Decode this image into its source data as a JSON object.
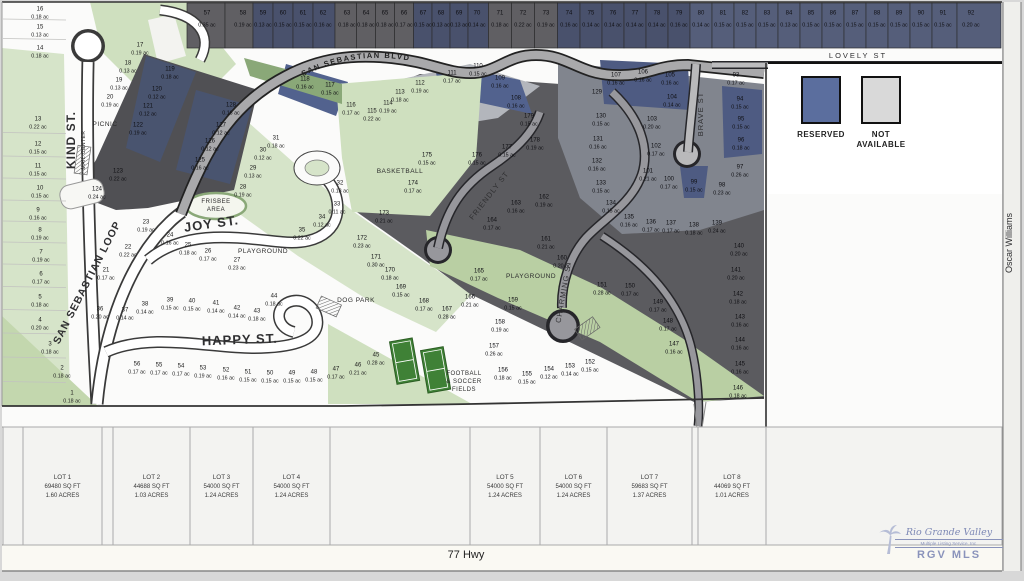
{
  "title": "Subdivision plat map",
  "legend": {
    "items": [
      {
        "label": "RESERVED",
        "color": "#5b6e9e"
      },
      {
        "label": "NOT AVAILABLE",
        "color": "#d9d9d9"
      }
    ]
  },
  "highway": {
    "label": "77 Hwy"
  },
  "logo": {
    "line1": "Rio Grande Valley",
    "line2": "Multiple Listing Service, Inc.",
    "line3": "RGV MLS"
  },
  "streets": [
    {
      "t": "KIND ST.",
      "x": 75,
      "y": 140,
      "r": -90,
      "s": 12,
      "ls": 1,
      "b": true
    },
    {
      "t": "SAN SEBASTIAN LOOP",
      "x": 90,
      "y": 284,
      "r": -63,
      "s": 10.5,
      "ls": 1,
      "b": true
    },
    {
      "t": "JOY ST.",
      "x": 212,
      "y": 228,
      "r": -8,
      "s": 13,
      "ls": 1,
      "b": true
    },
    {
      "t": "HAPPY ST.",
      "x": 240,
      "y": 344,
      "r": -2,
      "s": 13,
      "ls": 1,
      "b": true
    },
    {
      "t": "FRIENDLY ST",
      "x": 491,
      "y": 197,
      "r": -52,
      "s": 7.5,
      "ls": 1,
      "b": false
    },
    {
      "t": "CHARMING ST",
      "x": 566,
      "y": 292,
      "r": -80,
      "s": 7.5,
      "ls": 1,
      "b": false
    },
    {
      "t": "BRAVE ST",
      "x": 703,
      "y": 114,
      "r": -90,
      "s": 7.5,
      "ls": 1,
      "b": false
    },
    {
      "t": "LOVELY ST",
      "x": 858,
      "y": 58,
      "r": 0,
      "s": 7.5,
      "ls": 2,
      "b": false
    },
    {
      "t": "Oscar Williams",
      "x": 1012,
      "y": 243,
      "r": -90,
      "s": 9,
      "ls": 0,
      "b": false
    }
  ],
  "blvd_label": "SAN SEBASTIAN BLVD",
  "amenities": [
    {
      "lines": [
        "PICNIC"
      ],
      "x": 105,
      "y": 126,
      "s": 6.5,
      "r": 0
    },
    {
      "lines": [
        "MAIL CENTER"
      ],
      "x": 85,
      "y": 150,
      "s": 5,
      "r": -90
    },
    {
      "lines": [
        "FRISBEE",
        "AREA"
      ],
      "x": 216,
      "y": 203,
      "s": 6,
      "r": 0
    },
    {
      "lines": [
        "PLAYGROUND"
      ],
      "x": 263,
      "y": 253,
      "s": 6.5,
      "r": 0
    },
    {
      "lines": [
        "DOG PARK"
      ],
      "x": 356,
      "y": 302,
      "s": 6.5,
      "r": 0
    },
    {
      "lines": [
        "BASKETBALL"
      ],
      "x": 400,
      "y": 173,
      "s": 6.5,
      "r": 0
    },
    {
      "lines": [
        "PLAYGROUND"
      ],
      "x": 531,
      "y": 278,
      "s": 6.5,
      "r": 0
    },
    {
      "lines": [
        "FOOTBALL",
        "& SOCCER",
        "FIELDS"
      ],
      "x": 464,
      "y": 375,
      "s": 6,
      "r": 0
    }
  ],
  "lots": [
    [
      "1",
      "0.18 ac",
      72,
      392,
      "w"
    ],
    [
      "2",
      "0.18 ac",
      62,
      367,
      "w"
    ],
    [
      "3",
      "0.18 ac",
      50,
      343,
      "w"
    ],
    [
      "4",
      "0.20 ac",
      40,
      319,
      "w"
    ],
    [
      "5",
      "0.18 ac",
      40,
      296,
      "w"
    ],
    [
      "6",
      "0.17 ac",
      41,
      273,
      "w"
    ],
    [
      "7",
      "0.19 ac",
      41,
      251,
      "w"
    ],
    [
      "8",
      "0.19 ac",
      40,
      229,
      "w"
    ],
    [
      "9",
      "0.16 ac",
      38,
      209,
      "w"
    ],
    [
      "10",
      "0.15 ac",
      40,
      187,
      "w"
    ],
    [
      "11",
      "0.15 ac",
      38,
      165,
      "w"
    ],
    [
      "12",
      "0.15 ac",
      38,
      143,
      "w"
    ],
    [
      "13",
      "0.22 ac",
      38,
      118,
      "w"
    ],
    [
      "14",
      "0.18 ac",
      40,
      47,
      "w"
    ],
    [
      "15",
      "0.13 ac",
      40,
      26,
      "w"
    ],
    [
      "16",
      "0.18 ac",
      40,
      8,
      "w"
    ],
    [
      "17",
      "0.19 ac",
      140,
      44,
      "w"
    ],
    [
      "18",
      "0.13 ac",
      128,
      62,
      "w"
    ],
    [
      "19",
      "0.13 ac",
      119,
      79,
      "w"
    ],
    [
      "20",
      "0.19 ac",
      110,
      96,
      "w"
    ],
    [
      "21",
      "0.17 ac",
      106,
      269,
      "w"
    ],
    [
      "22",
      "0.22 ac",
      128,
      246,
      "w"
    ],
    [
      "23",
      "0.19 ac",
      146,
      221,
      "w"
    ],
    [
      "24",
      "0.16 ac",
      170,
      234,
      "w"
    ],
    [
      "25",
      "0.18 ac",
      188,
      244,
      "w"
    ],
    [
      "26",
      "0.17 ac",
      208,
      250,
      "w"
    ],
    [
      "27",
      "0.23 ac",
      237,
      259,
      "w"
    ],
    [
      "28",
      "0.19 ac",
      243,
      186,
      "w"
    ],
    [
      "29",
      "0.13 ac",
      253,
      167,
      "w"
    ],
    [
      "30",
      "0.12 ac",
      263,
      149,
      "w"
    ],
    [
      "31",
      "0.18 ac",
      276,
      137,
      "w"
    ],
    [
      "32",
      "0.18 ac",
      340,
      182,
      "w"
    ],
    [
      "33",
      "0.11 ac",
      337,
      203,
      "w"
    ],
    [
      "34",
      "0.12 ac",
      322,
      216,
      "w"
    ],
    [
      "35",
      "0.22 ac",
      302,
      229,
      "w"
    ],
    [
      "36",
      "0.20 ac",
      100,
      308,
      "w"
    ],
    [
      "37",
      "0.14 ac",
      125,
      309,
      "w"
    ],
    [
      "38",
      "0.14 ac",
      145,
      303,
      "w"
    ],
    [
      "39",
      "0.15 ac",
      170,
      299,
      "w"
    ],
    [
      "40",
      "0.15 ac",
      192,
      300,
      "w"
    ],
    [
      "41",
      "0.14 ac",
      216,
      302,
      "w"
    ],
    [
      "42",
      "0.14 ac",
      237,
      307,
      "w"
    ],
    [
      "43",
      "0.18 ac",
      257,
      310,
      "w"
    ],
    [
      "44",
      "0.18 ac",
      274,
      295,
      "w"
    ],
    [
      "45",
      "0.28 ac",
      376,
      354,
      "w"
    ],
    [
      "46",
      "0.21 ac",
      358,
      364,
      "w"
    ],
    [
      "47",
      "0.17 ac",
      336,
      368,
      "w"
    ],
    [
      "48",
      "0.15 ac",
      314,
      371,
      "w"
    ],
    [
      "49",
      "0.15 ac",
      292,
      372,
      "w"
    ],
    [
      "50",
      "0.15 ac",
      270,
      372,
      "w"
    ],
    [
      "51",
      "0.15 ac",
      248,
      371,
      "w"
    ],
    [
      "52",
      "0.16 ac",
      226,
      369,
      "w"
    ],
    [
      "53",
      "0.19 ac",
      203,
      367,
      "w"
    ],
    [
      "54",
      "0.17 ac",
      181,
      365,
      "w"
    ],
    [
      "55",
      "0.17 ac",
      159,
      364,
      "w"
    ],
    [
      "56",
      "0.17 ac",
      137,
      363,
      "w"
    ],
    [
      "57",
      "0.35 ac",
      207,
      12,
      "sg"
    ],
    [
      "58",
      "0.19 ac",
      243,
      12,
      "sg"
    ],
    [
      "59",
      "0.13 ac",
      263,
      12,
      "sn"
    ],
    [
      "60",
      "0.15 ac",
      283,
      12,
      "sn"
    ],
    [
      "61",
      "0.15 ac",
      303,
      12,
      "sn"
    ],
    [
      "62",
      "0.16 ac",
      323,
      12,
      "sn"
    ],
    [
      "63",
      "0.18 ac",
      347,
      12,
      "sg"
    ],
    [
      "64",
      "0.18 ac",
      366,
      12,
      "sg"
    ],
    [
      "65",
      "0.18 ac",
      385,
      12,
      "sg"
    ],
    [
      "66",
      "0.17 ac",
      404,
      12,
      "sg"
    ],
    [
      "67",
      "0.15 ac",
      423,
      12,
      "sn"
    ],
    [
      "68",
      "0.13 ac",
      441,
      12,
      "sn"
    ],
    [
      "69",
      "0.13 ac",
      459,
      12,
      "sn"
    ],
    [
      "70",
      "0.14 ac",
      477,
      12,
      "sn"
    ],
    [
      "71",
      "0.18 ac",
      500,
      12,
      "sg"
    ],
    [
      "72",
      "0.22 ac",
      523,
      12,
      "sg"
    ],
    [
      "73",
      "0.19 ac",
      546,
      12,
      "sg"
    ],
    [
      "74",
      "0.16 ac",
      569,
      12,
      "sn"
    ],
    [
      "75",
      "0.14 ac",
      591,
      12,
      "sn"
    ],
    [
      "76",
      "0.14 ac",
      613,
      12,
      "sn"
    ],
    [
      "77",
      "0.14 ac",
      635,
      12,
      "sn"
    ],
    [
      "78",
      "0.14 ac",
      657,
      12,
      "sn"
    ],
    [
      "79",
      "0.16 ac",
      679,
      12,
      "sn"
    ],
    [
      "80",
      "0.14 ac",
      701,
      12,
      "sl"
    ],
    [
      "81",
      "0.15 ac",
      723,
      12,
      "sl"
    ],
    [
      "82",
      "0.15 ac",
      745,
      12,
      "sl"
    ],
    [
      "83",
      "0.15 ac",
      767,
      12,
      "sl"
    ],
    [
      "84",
      "0.13 ac",
      789,
      12,
      "sl"
    ],
    [
      "85",
      "0.15 ac",
      811,
      12,
      "sl"
    ],
    [
      "86",
      "0.15 ac",
      833,
      12,
      "sl"
    ],
    [
      "87",
      "0.15 ac",
      855,
      12,
      "sl"
    ],
    [
      "88",
      "0.15 ac",
      877,
      12,
      "sl"
    ],
    [
      "89",
      "0.15 ac",
      899,
      12,
      "sl"
    ],
    [
      "90",
      "0.15 ac",
      921,
      12,
      "sl"
    ],
    [
      "91",
      "0.15 ac",
      943,
      12,
      "sl"
    ],
    [
      "92",
      "0.20 ac",
      971,
      12,
      "sl"
    ],
    [
      "93",
      "0.17 ac",
      736,
      74,
      "d"
    ],
    [
      "94",
      "0.15 ac",
      740,
      98,
      "d"
    ],
    [
      "95",
      "0.15 ac",
      741,
      118,
      "d"
    ],
    [
      "96",
      "0.18 ac",
      741,
      139,
      "d"
    ],
    [
      "97",
      "0.26 ac",
      740,
      166,
      "d"
    ],
    [
      "98",
      "0.23 ac",
      722,
      184,
      "d"
    ],
    [
      "99",
      "0.15 ac",
      694,
      181,
      "d"
    ],
    [
      "100",
      "0.17 ac",
      669,
      178,
      "d"
    ],
    [
      "101",
      "0.21 ac",
      648,
      170,
      "d"
    ],
    [
      "102",
      "0.17 ac",
      656,
      145,
      "d"
    ],
    [
      "103",
      "0.20 ac",
      652,
      118,
      "d"
    ],
    [
      "104",
      "0.14 ac",
      672,
      96,
      "d"
    ],
    [
      "105",
      "0.16 ac",
      670,
      74,
      "d"
    ],
    [
      "106",
      "0.16 ac",
      643,
      71,
      "d"
    ],
    [
      "107",
      "0.16 ac",
      616,
      74,
      "d"
    ],
    [
      "108",
      "0.16 ac",
      516,
      97,
      "d"
    ],
    [
      "109",
      "0.16 ac",
      500,
      77,
      "d"
    ],
    [
      "110",
      "0.15 ac",
      478,
      65,
      "d"
    ],
    [
      "111",
      "0.17 ac",
      452,
      72,
      "d"
    ],
    [
      "112",
      "0.19 ac",
      420,
      82,
      "w"
    ],
    [
      "113",
      "0.18 ac",
      400,
      91,
      "w"
    ],
    [
      "114",
      "0.19 ac",
      388,
      102,
      "w"
    ],
    [
      "115",
      "0.22 ac",
      372,
      110,
      "w"
    ],
    [
      "116",
      "0.17 ac",
      351,
      104,
      "w"
    ],
    [
      "117",
      "0.15 ac",
      330,
      84,
      "d"
    ],
    [
      "118",
      "0.16 ac",
      305,
      78,
      "d"
    ],
    [
      "119",
      "0.18 ac",
      170,
      68,
      "d"
    ],
    [
      "120",
      "0.12 ac",
      157,
      88,
      "d"
    ],
    [
      "121",
      "0.12 ac",
      148,
      105,
      "d"
    ],
    [
      "122",
      "0.19 ac",
      138,
      124,
      "d"
    ],
    [
      "123",
      "0.22 ac",
      118,
      170,
      "d"
    ],
    [
      "124",
      "0.24 ac",
      97,
      188,
      "d"
    ],
    [
      "125",
      "0.16 ac",
      200,
      159,
      "d"
    ],
    [
      "126",
      "0.12 ac",
      210,
      140,
      "d"
    ],
    [
      "127",
      "0.12 ac",
      221,
      124,
      "d"
    ],
    [
      "128",
      "0.16 ac",
      231,
      104,
      "d"
    ],
    [
      "129",
      "",
      597,
      91,
      "d"
    ],
    [
      "130",
      "0.15 ac",
      601,
      115,
      "d"
    ],
    [
      "131",
      "0.16 ac",
      598,
      138,
      "d"
    ],
    [
      "132",
      "0.16 ac",
      597,
      160,
      "d"
    ],
    [
      "133",
      "0.15 ac",
      601,
      182,
      "d"
    ],
    [
      "134",
      "0.15 ac",
      611,
      202,
      "d"
    ],
    [
      "135",
      "0.16 ac",
      629,
      216,
      "d"
    ],
    [
      "136",
      "0.17 ac",
      651,
      221,
      "d"
    ],
    [
      "137",
      "0.17 ac",
      671,
      222,
      "d"
    ],
    [
      "138",
      "0.18 ac",
      694,
      224,
      "d"
    ],
    [
      "139",
      "0.24 ac",
      717,
      222,
      "d"
    ],
    [
      "140",
      "0.20 ac",
      739,
      245,
      "d"
    ],
    [
      "141",
      "0.20 ac",
      736,
      269,
      "d"
    ],
    [
      "142",
      "0.18 ac",
      738,
      293,
      "d"
    ],
    [
      "143",
      "0.16 ac",
      740,
      316,
      "d"
    ],
    [
      "144",
      "0.16 ac",
      740,
      339,
      "d"
    ],
    [
      "145",
      "0.16 ac",
      740,
      363,
      "d"
    ],
    [
      "146",
      "0.18 ac",
      738,
      387,
      "d"
    ],
    [
      "147",
      "0.16 ac",
      674,
      343,
      "d"
    ],
    [
      "148",
      "0.17 ac",
      668,
      320,
      "d"
    ],
    [
      "149",
      "0.17 ac",
      658,
      301,
      "d"
    ],
    [
      "150",
      "0.17 ac",
      630,
      285,
      "d"
    ],
    [
      "151",
      "0.28 ac",
      602,
      284,
      "d"
    ],
    [
      "152",
      "0.15 ac",
      590,
      361,
      "d"
    ],
    [
      "153",
      "0.14 ac",
      570,
      365,
      "d"
    ],
    [
      "154",
      "0.12 ac",
      549,
      368,
      "d"
    ],
    [
      "155",
      "0.15 ac",
      527,
      373,
      "d"
    ],
    [
      "156",
      "0.18 ac",
      503,
      369,
      "d"
    ],
    [
      "157",
      "0.26 ac",
      494,
      345,
      "d"
    ],
    [
      "158",
      "0.19 ac",
      500,
      321,
      "d"
    ],
    [
      "159",
      "0.15 ac",
      513,
      299,
      "d"
    ],
    [
      "160",
      "0.20 ac",
      562,
      257,
      "d"
    ],
    [
      "161",
      "0.21 ac",
      546,
      238,
      "d"
    ],
    [
      "162",
      "0.19 ac",
      544,
      196,
      "d"
    ],
    [
      "163",
      "0.16 ac",
      516,
      202,
      "d"
    ],
    [
      "164",
      "0.17 ac",
      492,
      219,
      "d"
    ],
    [
      "165",
      "0.17 ac",
      479,
      270,
      "d"
    ],
    [
      "166",
      "0.21 ac",
      470,
      296,
      "d"
    ],
    [
      "167",
      "0.28 ac",
      447,
      308,
      "d"
    ],
    [
      "168",
      "0.17 ac",
      424,
      300,
      "d"
    ],
    [
      "169",
      "0.15 ac",
      401,
      286,
      "d"
    ],
    [
      "170",
      "0.18 ac",
      390,
      269,
      "d"
    ],
    [
      "171",
      "0.30 ac",
      376,
      256,
      "d"
    ],
    [
      "172",
      "0.23 ac",
      362,
      237,
      "d"
    ],
    [
      "173",
      "0.21 ac",
      384,
      212,
      "d"
    ],
    [
      "174",
      "0.17 ac",
      413,
      182,
      "d"
    ],
    [
      "175",
      "0.15 ac",
      427,
      154,
      "d"
    ],
    [
      "176",
      "0.15 ac",
      477,
      154,
      "d"
    ],
    [
      "177",
      "0.15 ac",
      507,
      146,
      "d"
    ],
    [
      "178",
      "0.19 ac",
      535,
      139,
      "d"
    ],
    [
      "179",
      "0.15 ac",
      529,
      115,
      "d"
    ]
  ],
  "bottom_lots": {
    "cells": [
      {
        "x": 3,
        "w": 20
      },
      {
        "x": 23,
        "w": 79,
        "name": "LOT 1",
        "sqft": "69480 SQ FT",
        "acres": "1.60 ACRES"
      },
      {
        "x": 102,
        "w": 11
      },
      {
        "x": 113,
        "w": 77,
        "name": "LOT 2",
        "sqft": "44688 SQ FT",
        "acres": "1.03 ACRES"
      },
      {
        "x": 190,
        "w": 63,
        "name": "LOT 3",
        "sqft": "54000 SQ FT",
        "acres": "1.24 ACRES"
      },
      {
        "x": 253,
        "w": 77,
        "name": "LOT 4",
        "sqft": "54000 SQ FT",
        "acres": "1.24 ACRES"
      },
      {
        "x": 330,
        "w": 140
      },
      {
        "x": 470,
        "w": 70,
        "name": "LOT 5",
        "sqft": "54000 SQ FT",
        "acres": "1.24 ACRES"
      },
      {
        "x": 540,
        "w": 67,
        "name": "LOT 6",
        "sqft": "54000 SQ FT",
        "acres": "1.24 ACRES"
      },
      {
        "x": 607,
        "w": 85,
        "name": "LOT 7",
        "sqft": "59683 SQ FT",
        "acres": "1.37 ACRES"
      },
      {
        "x": 692,
        "w": 6
      },
      {
        "x": 698,
        "w": 68,
        "name": "LOT 8",
        "sqft": "44069 SQ FT",
        "acres": "1.01 ACRES"
      },
      {
        "x": 766,
        "w": 236
      }
    ]
  }
}
